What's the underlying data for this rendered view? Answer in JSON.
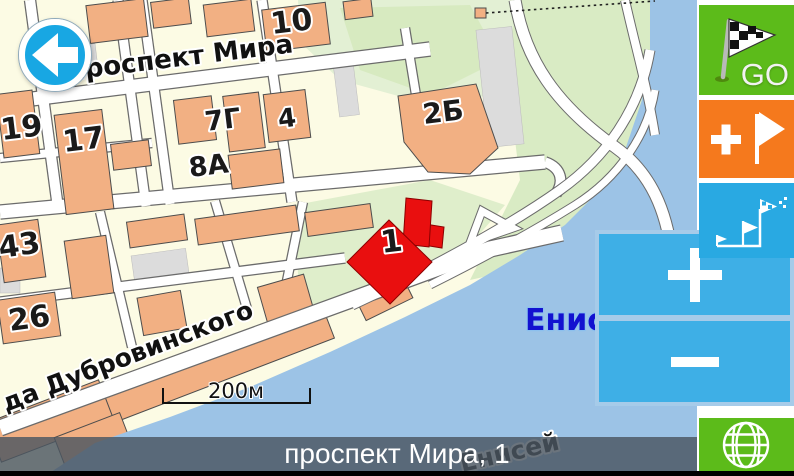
{
  "map": {
    "street_labels": [
      {
        "text": "проспект Мира"
      },
      {
        "text": "да Дубровинского"
      }
    ],
    "water_labels": [
      {
        "text": "Енисей"
      },
      {
        "text": "Енисей"
      }
    ],
    "building_labels": [
      {
        "text": "10"
      },
      {
        "text": "19"
      },
      {
        "text": "17"
      },
      {
        "text": "7Г"
      },
      {
        "text": "4"
      },
      {
        "text": "8А"
      },
      {
        "text": "2Б"
      },
      {
        "text": "43"
      },
      {
        "text": "26"
      }
    ],
    "marker": {
      "label": "1"
    },
    "scale": {
      "label": "200м"
    }
  },
  "sidebar": {
    "go": {
      "label": "GO",
      "icon": "checkered-flag-icon"
    },
    "add_waypoint": {
      "icon": "plus-flag-icon"
    },
    "route": {
      "icon": "route-flags-icon"
    },
    "zoom_in": {
      "icon": "plus-icon"
    },
    "zoom_out": {
      "icon": "minus-icon"
    },
    "globe": {
      "icon": "globe-icon"
    }
  },
  "back_button": {
    "icon": "arrow-left-icon"
  },
  "status_bar": {
    "address": "проспект Мира, 1"
  },
  "colors": {
    "land": "#FCFBE4",
    "water": "#9CC3E6",
    "building": "#F2B083",
    "green_area": "#DFEECB",
    "go_green": "#5CBB1A",
    "orange": "#F5791D",
    "route_blue": "#29A9E2",
    "zoom_blue": "#3EAFE6",
    "zoom_border": "#A6CBE9",
    "back_blue": "#18A7E3",
    "marker_red": "#E90F0F",
    "bar_bg": "#4A5560",
    "water_label_blue": "#1211D0"
  }
}
